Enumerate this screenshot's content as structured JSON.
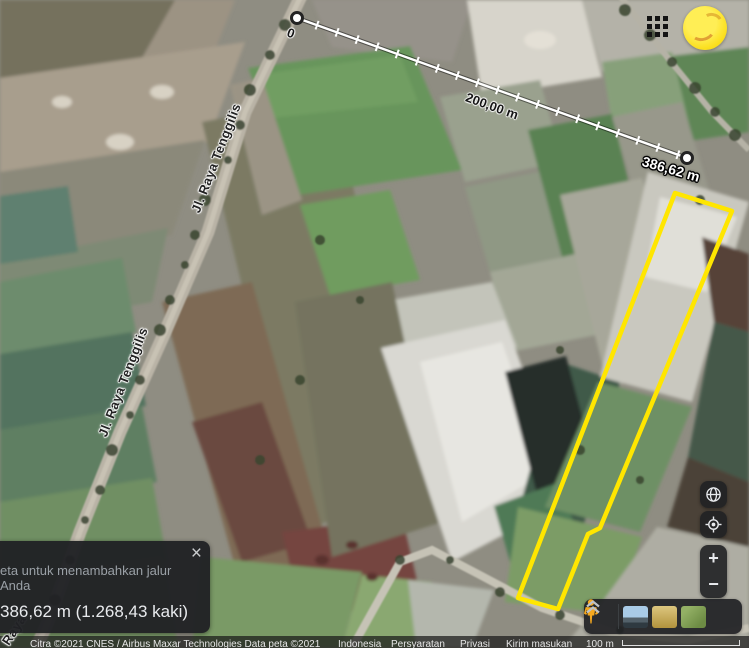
{
  "map": {
    "road_labels": [
      {
        "text": "Jl. Raya Tenggilis"
      },
      {
        "text": "Jl. Raya Tenggilis"
      },
      {
        "text": "Raya"
      }
    ],
    "measurement": {
      "start_label": "0",
      "mid_label": "200,00 m",
      "end_label": "386,62 m",
      "start": {
        "x": 297,
        "y": 18
      },
      "end": {
        "x": 687,
        "y": 158
      },
      "tick_interval_px": 21.3,
      "line_color": "#ffffff"
    },
    "selection_polygon": {
      "color": "#ffe600",
      "points": [
        [
          675,
          193
        ],
        [
          732,
          211
        ],
        [
          600,
          528
        ],
        [
          588,
          534
        ],
        [
          558,
          609
        ],
        [
          518,
          598
        ]
      ]
    }
  },
  "header": {
    "apps_icon": "apps-grid",
    "avatar": "yellow-account-avatar"
  },
  "measure_panel": {
    "message": "eta untuk menambahkan jalur Anda",
    "total": "386,62 m (1.268,43 kaki)",
    "close": "×"
  },
  "controls": {
    "zoom_in": "+",
    "zoom_out": "−"
  },
  "attribution": {
    "imagery": "Citra ©2021 CNES / Airbus Maxar Technologies Data peta ©2021",
    "links": [
      "Indonesia",
      "Persyaratan",
      "Privasi",
      "Kirim masukan"
    ],
    "scale_label": "100 m"
  }
}
